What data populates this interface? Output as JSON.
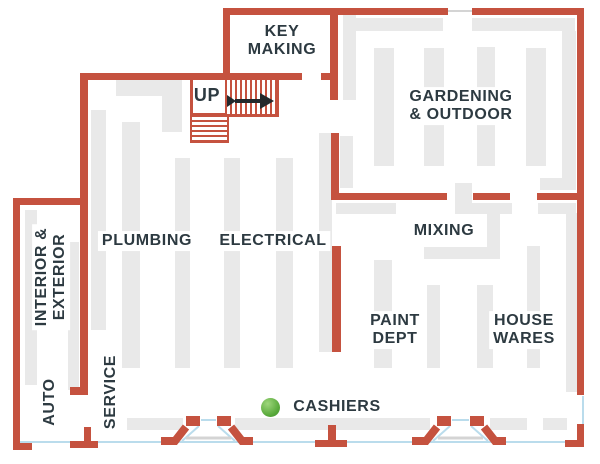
{
  "diagram_type": "hardware store floor plan",
  "colors": {
    "wall": "#c5523f",
    "shelf": "#e9e9e9",
    "text": "#2d3a41",
    "door_line": "#badcec",
    "door_leaf": "#d4d4d4",
    "stair_arrow": "#23292c",
    "marker_hi": "#9ed67c",
    "marker_mid": "#58a93a",
    "marker_edge": "#418f2c",
    "background": "#ffffff"
  },
  "rooms": {
    "key_making": {
      "line1": "KEY",
      "line2": "MAKING"
    },
    "gardening_outdoor": {
      "line1": "GARDENING",
      "line2": "& OUTDOOR"
    },
    "plumbing": {
      "label": "PLUMBING"
    },
    "electrical": {
      "label": "ELECTRICAL"
    },
    "mixing": {
      "label": "MIXING"
    },
    "interior_exterior": {
      "line1": "INTERIOR &",
      "line2": "EXTERIOR"
    },
    "auto": {
      "label": "AUTO"
    },
    "service": {
      "label": "SERVICE"
    },
    "paint_dept": {
      "line1": "PAINT",
      "line2": "DEPT"
    },
    "house_wares": {
      "line1": "HOUSE",
      "line2": "WARES"
    },
    "cashiers": {
      "label": "CASHIERS"
    }
  },
  "stairs": {
    "label": "UP",
    "direction_icon": "arrow-right-icon"
  },
  "markers": {
    "cashiers_dot": "green-location-dot"
  }
}
